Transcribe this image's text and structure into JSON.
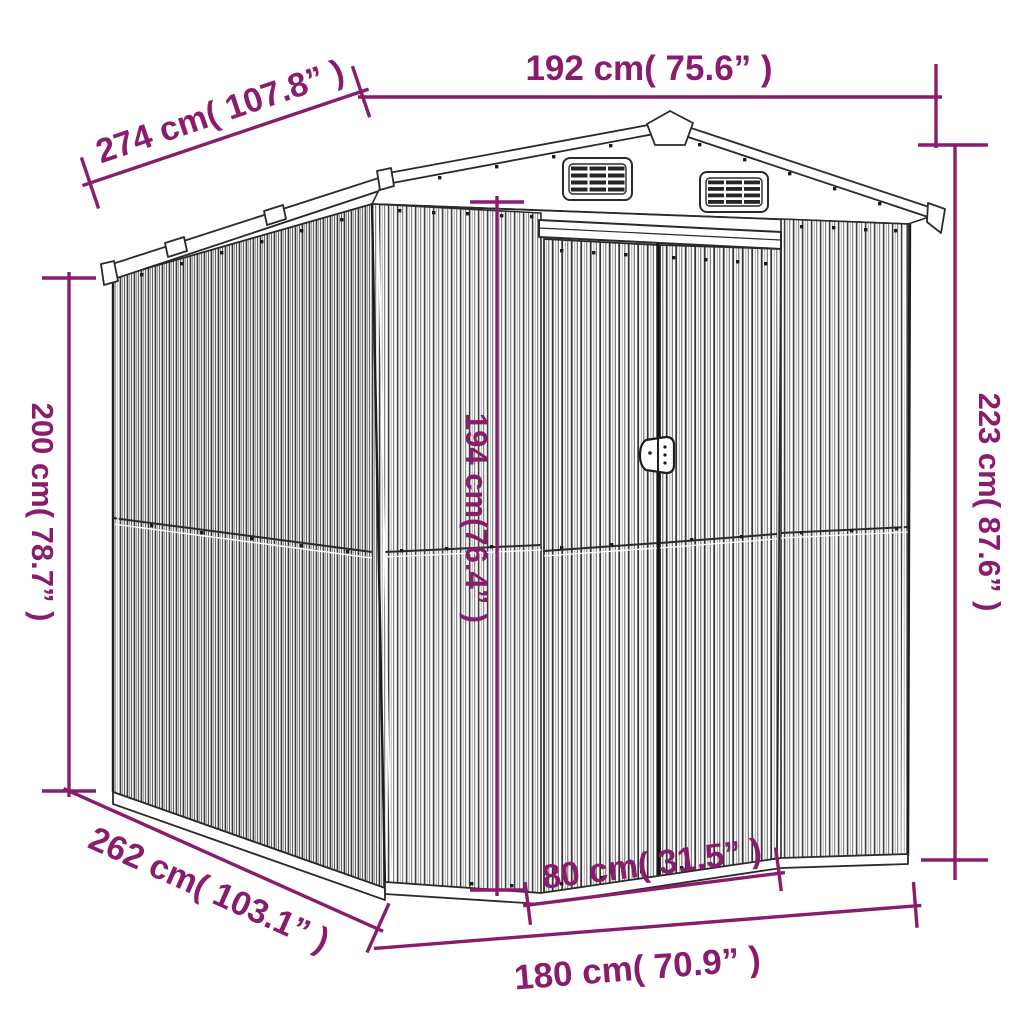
{
  "page": {
    "background": "#ffffff",
    "description": "garden shed technical dimension drawing"
  },
  "colors": {
    "dimension": "#8a1c6e",
    "drawing_line": "#2a2a2a"
  },
  "dimensions": {
    "top_width": {
      "cm": 192,
      "inch": 75.6,
      "label": "192 cm( 75.6” )"
    },
    "roof_depth": {
      "cm": 274,
      "inch": 107.8,
      "label": "274 cm( 107.8” )"
    },
    "left_height": {
      "cm": 200,
      "inch": 78.7,
      "label": "200 cm( 78.7” )"
    },
    "right_height": {
      "cm": 223,
      "inch": 87.6,
      "label": "223 cm( 87.6” )"
    },
    "door_height": {
      "cm": 194,
      "inch": 76.4,
      "label": "194 cm(76.4” )"
    },
    "door_width": {
      "cm": 80,
      "inch": 31.5,
      "label": "80 cm( 31.5” )"
    },
    "base_width": {
      "cm": 180,
      "inch": 70.9,
      "label": "180 cm( 70.9” )"
    },
    "base_depth": {
      "cm": 262,
      "inch": 103.1,
      "label": "262 cm( 103.1” )"
    }
  }
}
